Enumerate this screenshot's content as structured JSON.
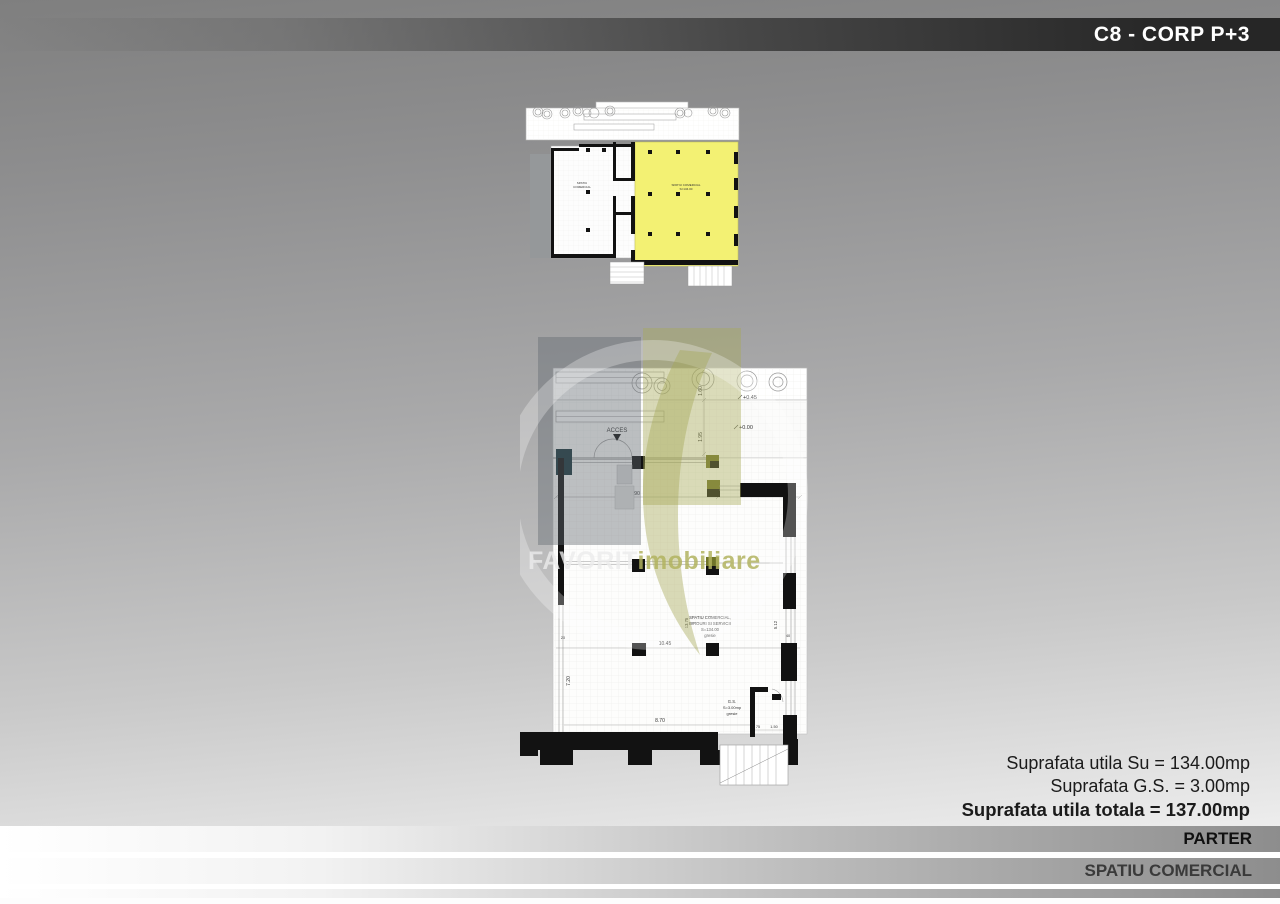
{
  "header": {
    "title": "C8 - CORP P+3"
  },
  "watermark": {
    "brand": "FAVORIT",
    "brand_suffix": "imobiliare"
  },
  "summary": {
    "usable": "Suprafata utila Su = 134.00mp",
    "gs": "Suprafata G.S. = 3.00mp",
    "total": "Suprafata utila totala = 137.00mp"
  },
  "footer": {
    "floor_label": "PARTER",
    "unit_label": "SPATIU COMERCIAL"
  },
  "colors": {
    "highlight_yellow": "#f3f173",
    "brand_olive": "#b0b169",
    "title_bar_dark": "#262626",
    "watermark_gray": "#626a70"
  },
  "large_plan": {
    "access": "ACCES",
    "elevation_entrance": "+0.45",
    "elevation_floor": "+0.00",
    "room_label": {
      "line1": "SPATIU COMERCIAL,",
      "line2": "BIROURI SI SERVICII",
      "line3": "S=134.00",
      "line4": "gresie"
    },
    "gs_label": {
      "line1": "G.S.",
      "line2": "S=3.00mp",
      "line3": "gresie"
    },
    "dims": {
      "sidewalk_depth": "1.60",
      "plaza_depth": "1.95",
      "storefront_width": "6.90",
      "terrace_width": "3.55",
      "room_width": "10.45",
      "room_width_lower": "8.70",
      "room_depth_left": "7.20",
      "room_depth_mid": "13.75",
      "room_depth_right": "5.12",
      "gs_width": "1.50",
      "gs_wall": "75",
      "wall_thickness": "20",
      "column_width": "40"
    }
  },
  "small_plan": {
    "left_unit_label": {
      "line1": "SPATIU",
      "line2": "COMERCIAL"
    },
    "right_unit_label": {
      "line1": "SPATIU COMERCIAL",
      "line2": "S=134.00"
    }
  }
}
